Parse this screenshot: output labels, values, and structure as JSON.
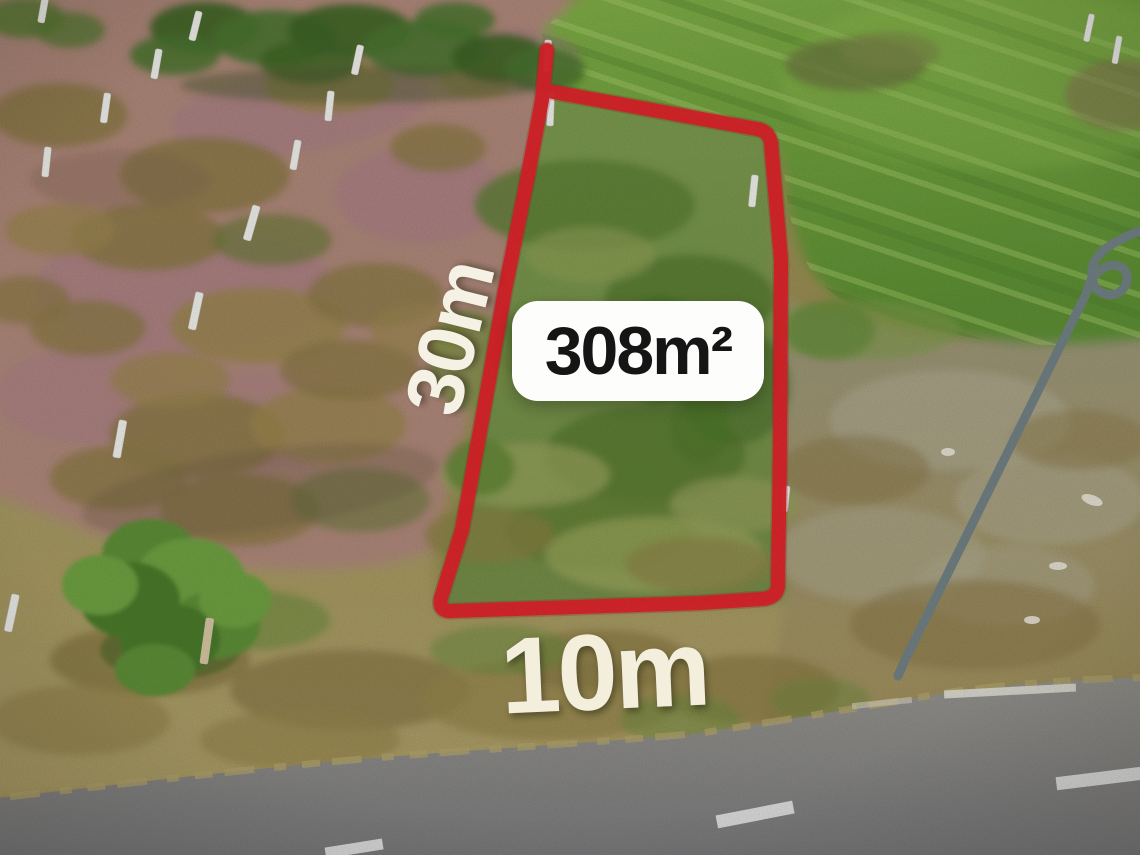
{
  "photo": {
    "description": "Aerial drone photo of a vacant land plot marked for sale with a red boundary outline",
    "annotations": {
      "area_label": "308m²",
      "side_length_label": "30m",
      "frontage_label": "10m"
    },
    "colors": {
      "outline_red": "#e4252c",
      "area_badge_bg": "#fdfdfc",
      "area_badge_text": "#151515",
      "dimension_text": "#f5f1e4",
      "road_gray": "#8d8d8f",
      "field_green": "#74a33e",
      "dirt_pink": "#b18a7c",
      "dry_grass_tan": "#a79a62"
    },
    "scene_elements": [
      "red-plot-outline",
      "area-badge",
      "green-crop-field",
      "pink-dirt-field",
      "survey-stakes",
      "tree",
      "street-light-pole",
      "asphalt-road",
      "road-lane-markings"
    ]
  }
}
